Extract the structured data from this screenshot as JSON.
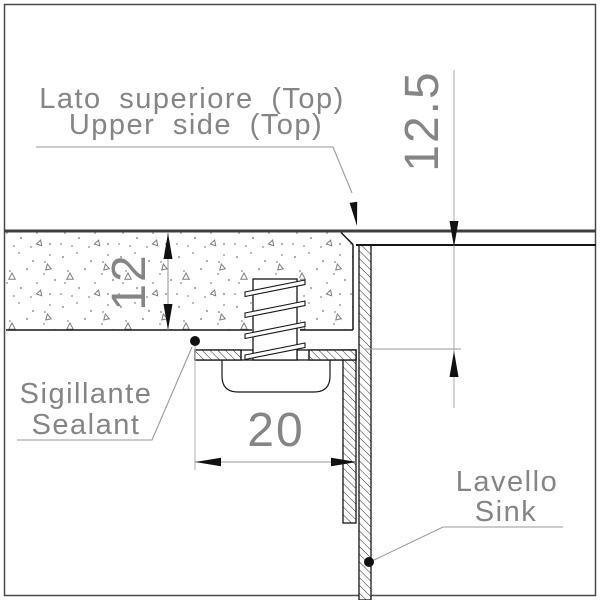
{
  "labels": {
    "top_surface": {
      "line1": "Lato superiore (Top)",
      "line2": "Upper side (Top)"
    },
    "sealant": {
      "line1": "Sigillante",
      "line2": "Sealant"
    },
    "sink": {
      "line1": "Lavello",
      "line2": "Sink"
    }
  },
  "dimensions": {
    "countertop_thickness": "12",
    "rim_recess_depth": "12.5",
    "flange_width": "20"
  },
  "colors": {
    "ink": "#1a1a1a",
    "annotation_gray": "#858585",
    "dim_line_gray": "#9a9a9a",
    "surface_line": "#3f3f3f",
    "background": "#ffffff"
  }
}
